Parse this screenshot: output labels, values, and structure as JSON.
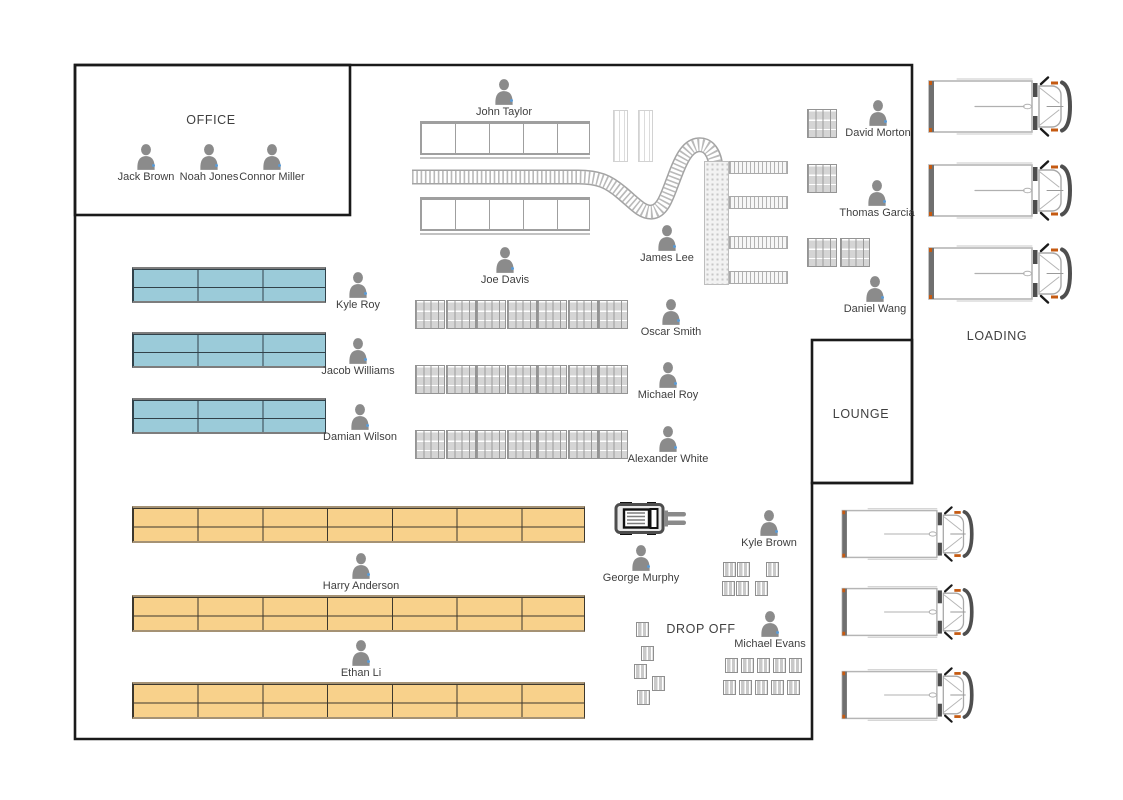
{
  "diagram": {
    "type": "warehouse-floor-plan",
    "rooms": {
      "office": "OFFICE",
      "lounge": "LOUNGE",
      "loading": "LOADING",
      "drop_off": "DROP OFF"
    },
    "people": [
      {
        "name": "Jack Brown",
        "x": 146,
        "y": 144
      },
      {
        "name": "Noah Jones",
        "x": 209,
        "y": 144
      },
      {
        "name": "Connor Miller",
        "x": 272,
        "y": 144
      },
      {
        "name": "John Taylor",
        "x": 504,
        "y": 79
      },
      {
        "name": "Joe Davis",
        "x": 505,
        "y": 247
      },
      {
        "name": "James Lee",
        "x": 667,
        "y": 225
      },
      {
        "name": "Oscar Smith",
        "x": 671,
        "y": 299
      },
      {
        "name": "Michael Roy",
        "x": 668,
        "y": 362
      },
      {
        "name": "Alexander White",
        "x": 668,
        "y": 426
      },
      {
        "name": "Kyle Roy",
        "x": 358,
        "y": 272
      },
      {
        "name": "Jacob Williams",
        "x": 358,
        "y": 338
      },
      {
        "name": "Damian Wilson",
        "x": 360,
        "y": 404
      },
      {
        "name": "Harry Anderson",
        "x": 361,
        "y": 553
      },
      {
        "name": "Ethan Li",
        "x": 361,
        "y": 640
      },
      {
        "name": "George Murphy",
        "x": 641,
        "y": 545
      },
      {
        "name": "Kyle Brown",
        "x": 769,
        "y": 510
      },
      {
        "name": "Michael Evans",
        "x": 770,
        "y": 611
      },
      {
        "name": "David Morton",
        "x": 878,
        "y": 100
      },
      {
        "name": "Thomas Garcia",
        "x": 877,
        "y": 180
      },
      {
        "name": "Daniel Wang",
        "x": 875,
        "y": 276
      }
    ],
    "colors": {
      "wall": "#1a1a1a",
      "rack_blue_fill": "#9bcbd9",
      "rack_blue_line": "#31424a",
      "rack_blue_edge": "#7d7d7d",
      "rack_orange_fill": "#f8d18b",
      "rack_orange_line": "#3d382e",
      "rack_orange_edge": "#a59274",
      "staging_line": "#9f9f9f",
      "person_gray": "#8b8b8b",
      "presence_dot_blue": "#5b9bd5",
      "truck_accent_orange": "#c55a11"
    },
    "storage": {
      "blue_racks": [
        {
          "x": 132,
          "y": 267
        },
        {
          "x": 132,
          "y": 332
        },
        {
          "x": 132,
          "y": 398
        }
      ],
      "blue_rack_size": {
        "w": 194,
        "h": 36,
        "cols": 3,
        "rows": 2
      },
      "orange_racks": [
        {
          "x": 132,
          "y": 506
        },
        {
          "x": 132,
          "y": 595
        },
        {
          "x": 132,
          "y": 682
        }
      ],
      "orange_rack_size": {
        "w": 453,
        "h": 37,
        "cols": 7,
        "rows": 2
      },
      "staging_racks": [
        {
          "x": 420,
          "y": 121
        },
        {
          "x": 420,
          "y": 197
        }
      ],
      "staging_rack_size": {
        "w": 170,
        "h": 34,
        "cols": 5,
        "rows": 1
      },
      "slim_racks": [
        {
          "x": 613,
          "y": 110
        },
        {
          "x": 638,
          "y": 110
        }
      ],
      "slim_rack_size": {
        "w": 15,
        "h": 52
      }
    },
    "pallet_groups": [
      {
        "x": 415,
        "y": 300,
        "count": 7,
        "pitch": 30.5
      },
      {
        "x": 415,
        "y": 365,
        "count": 7,
        "pitch": 30.5
      },
      {
        "x": 415,
        "y": 430,
        "count": 7,
        "pitch": 30.5
      },
      {
        "x": 807,
        "y": 109,
        "count": 1,
        "pitch": 0
      },
      {
        "x": 807,
        "y": 164,
        "count": 1,
        "pitch": 0
      },
      {
        "x": 807,
        "y": 238,
        "count": 2,
        "pitch": 32.5
      }
    ],
    "pallet_size": {
      "w": 30,
      "h": 29
    },
    "boxes": [
      [
        723,
        562
      ],
      [
        737,
        562
      ],
      [
        766,
        562
      ],
      [
        722,
        581
      ],
      [
        736,
        581
      ],
      [
        755,
        581
      ],
      [
        725,
        658
      ],
      [
        741,
        658
      ],
      [
        757,
        658
      ],
      [
        773,
        658
      ],
      [
        789,
        658
      ],
      [
        723,
        680
      ],
      [
        739,
        680
      ],
      [
        755,
        680
      ],
      [
        771,
        680
      ],
      [
        787,
        680
      ],
      [
        636,
        622
      ],
      [
        641,
        646
      ],
      [
        634,
        664
      ],
      [
        652,
        676
      ],
      [
        637,
        690
      ]
    ],
    "box_size": {
      "w": 13,
      "h": 15
    },
    "trucks": [
      {
        "x": 927,
        "y": 76,
        "w": 146,
        "h": 61
      },
      {
        "x": 927,
        "y": 160,
        "w": 146,
        "h": 61
      },
      {
        "x": 927,
        "y": 243,
        "w": 146,
        "h": 61
      },
      {
        "x": 835,
        "y": 506,
        "w": 145,
        "h": 56
      },
      {
        "x": 835,
        "y": 584,
        "w": 145,
        "h": 56
      },
      {
        "x": 835,
        "y": 667,
        "w": 145,
        "h": 56
      }
    ],
    "forklift": {
      "x": 614,
      "y": 502,
      "w": 73,
      "h": 33
    },
    "conveyor": {
      "lanes_y": [
        161,
        196,
        236,
        271
      ],
      "lane_x": 729,
      "lane_w": 59,
      "lane_h": 13,
      "column": {
        "x": 704,
        "y": 161,
        "w": 25,
        "h": 124
      }
    }
  }
}
